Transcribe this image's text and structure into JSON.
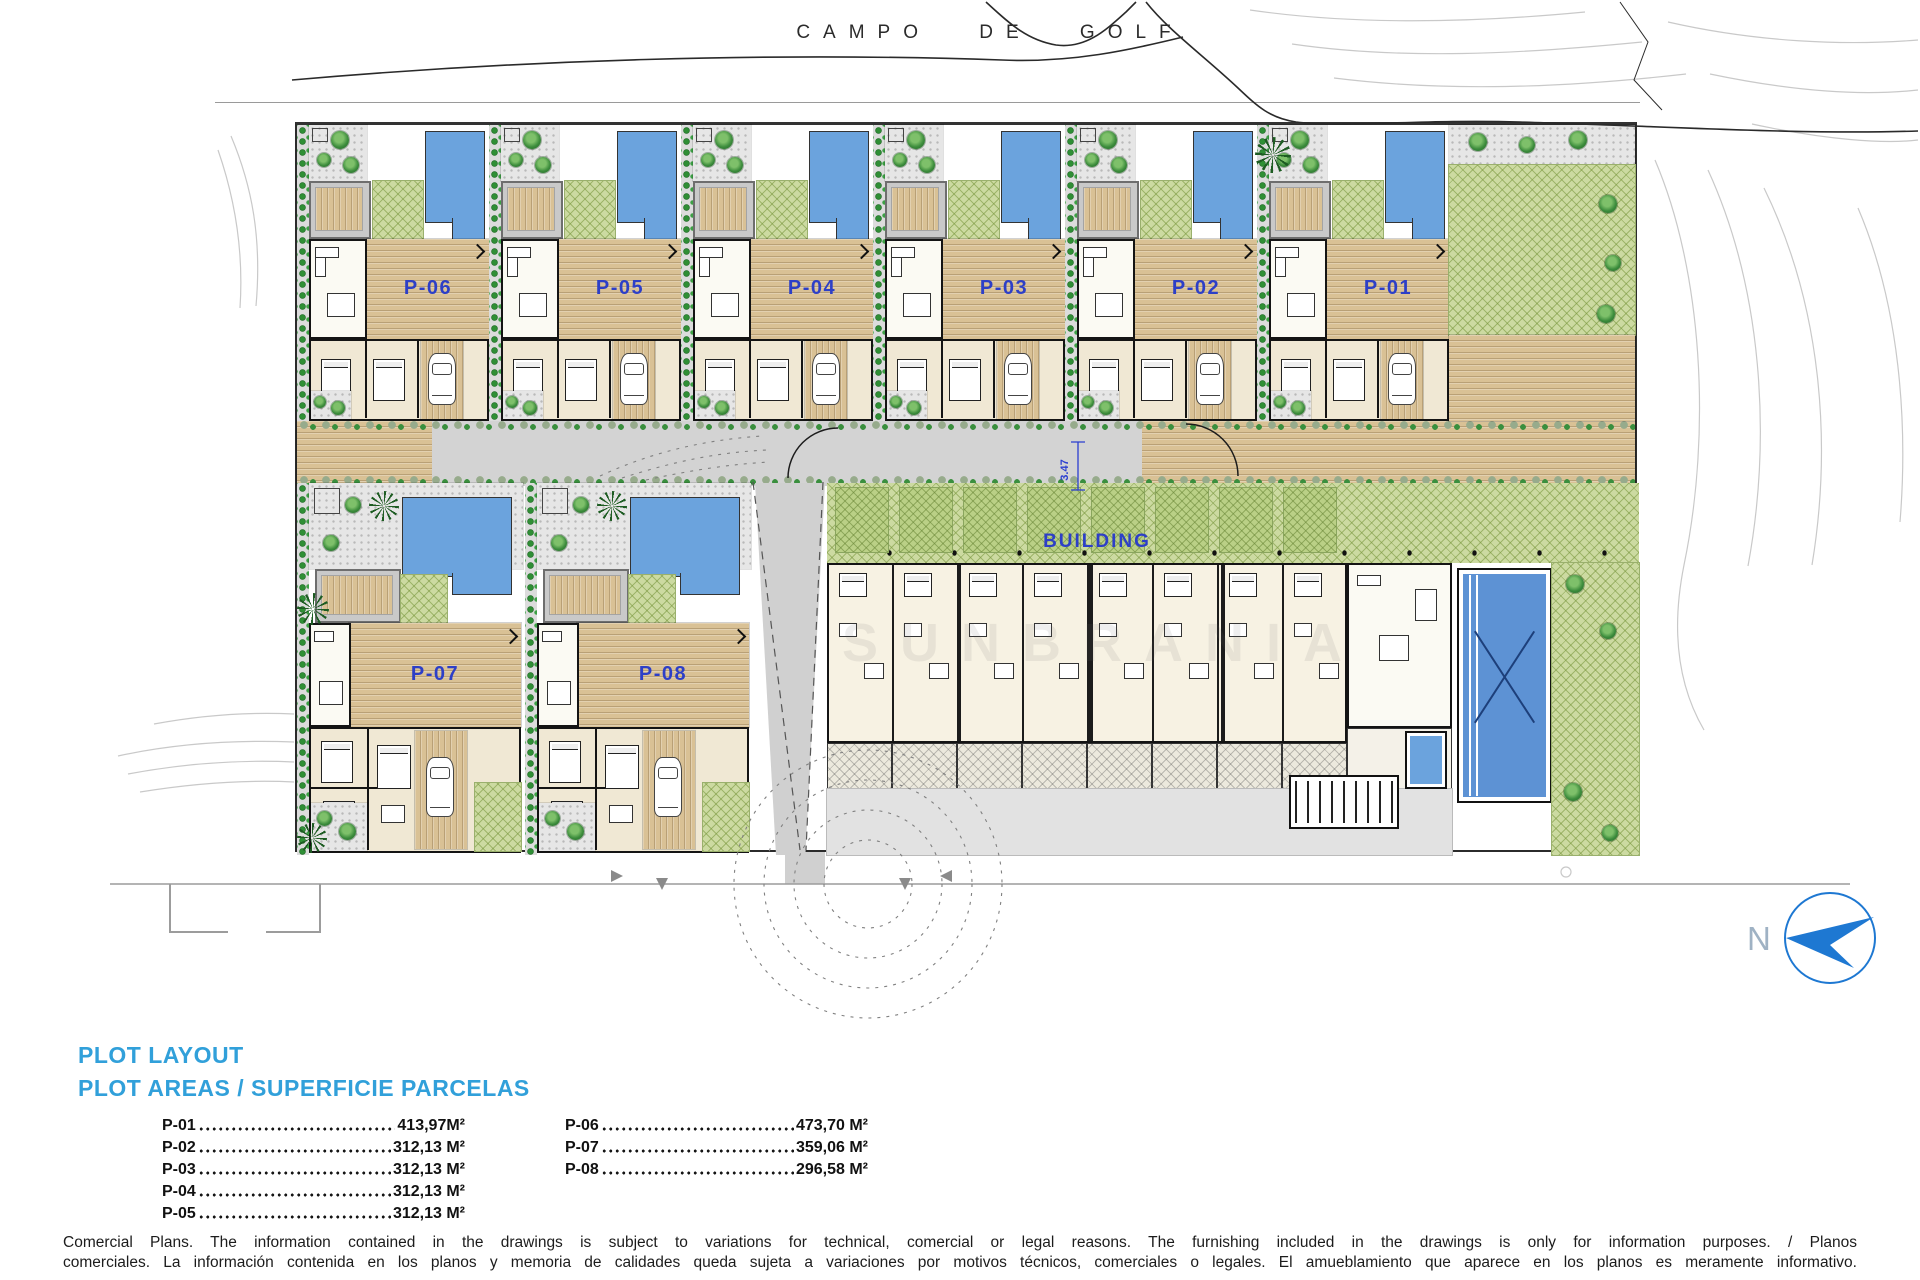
{
  "golf_label": {
    "text": "CAMPO DE GOLF"
  },
  "plan": {
    "top_plots": [
      {
        "label": "P-06"
      },
      {
        "label": "P-05"
      },
      {
        "label": "P-04"
      },
      {
        "label": "P-03"
      },
      {
        "label": "P-02"
      },
      {
        "label": "P-01"
      }
    ],
    "bottom_plots": [
      {
        "label": "P-07"
      },
      {
        "label": "P-08"
      }
    ],
    "building_label": "BUILDING",
    "road_dimension": "3.47",
    "watermark": "SUNBRANIA"
  },
  "north": {
    "label": "N"
  },
  "legend": {
    "title": "PLOT LAYOUT",
    "subtitle": "PLOT AREAS / SUPERFICIE PARCELAS",
    "col1": [
      {
        "plot": "P-01",
        "area": "413,97M²"
      },
      {
        "plot": "P-02",
        "area": "312,13 M²"
      },
      {
        "plot": "P-03",
        "area": "312,13 M²"
      },
      {
        "plot": "P-04",
        "area": "312,13 M²"
      },
      {
        "plot": "P-05",
        "area": "312,13 M²"
      }
    ],
    "col2": [
      {
        "plot": "P-06",
        "area": "473,70 M²"
      },
      {
        "plot": "P-07",
        "area": "359,06 M²"
      },
      {
        "plot": "P-08",
        "area": "296,58 M²"
      }
    ]
  },
  "disclaimer": {
    "line1": "Comercial Plans. The information contained in the drawings is subject to variations for technical, comercial or legal reasons. The furnishing included in the drawings is only for information purposes. / Planos",
    "line2": "comerciales. La información contenida en los planos y memoria de calidades queda sujeta a variaciones por motivos técnicos, comerciales o legales. El amueblamiento que aparece en los planos es meramente informativo."
  },
  "colors": {
    "accent_blue": "#31a0da",
    "label_blue": "#2d3fc7",
    "pool_blue": "#6ba3dd",
    "big_pool_blue": "#5d92d4",
    "north_blue": "#1e78d2",
    "deck_tan": "#d9c195",
    "lawn_green": "#ccdaa1",
    "hedge_green": "#2f8f35",
    "road_gray": "#d3d3d3"
  }
}
